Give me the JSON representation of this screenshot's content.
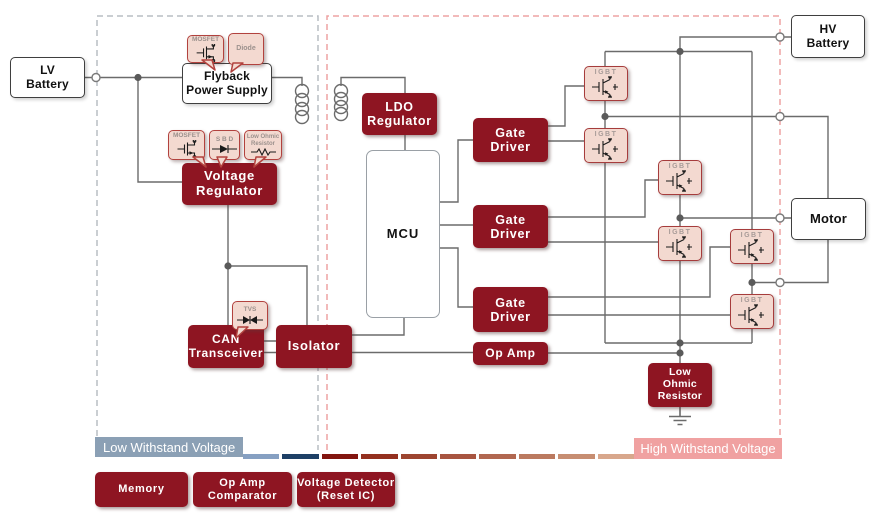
{
  "boxes": {
    "lv_battery": "LV\nBattery",
    "hv_battery": "HV\nBattery",
    "motor": "Motor",
    "flyback": "Flyback\nPower Supply",
    "voltage_regulator": "Voltage\nRegulator",
    "ldo_regulator": "LDO\nRegulator",
    "mcu": "MCU",
    "gate_driver": "Gate\nDriver",
    "can_transceiver": "CAN\nTransceiver",
    "isolator": "Isolator",
    "op_amp": "Op Amp",
    "low_ohmic_resistor": "Low\nOhmic\nResistor",
    "igbt": "IGBT"
  },
  "callouts": {
    "mosfet": "MOSFET",
    "diode": "Diode",
    "sbd": "S B D",
    "low_ohmic": "Low Ohmic\nResistor",
    "tvs": "TVS"
  },
  "bars": {
    "low_label": "Low Withstand Voltage",
    "high_label": "High Withstand Voltage",
    "low_color": "#8ba0b5",
    "high_color": "#f0a1a1",
    "segments": [
      "#86a0c2",
      "#1e4066",
      "#82150f",
      "#94301f",
      "#9d4530",
      "#a85540",
      "#b16750",
      "#bb7a60",
      "#c78e72",
      "#d8a78c"
    ]
  },
  "legend": [
    {
      "label": "Memory"
    },
    {
      "label": "Op Amp\nComparator"
    },
    {
      "label": "Voltage Detector\n(Reset IC)"
    }
  ],
  "colors": {
    "block_red": "#8e1522",
    "callout_fill": "#f3d9d0",
    "callout_border": "#b2423e",
    "wire": "#6b6b6b",
    "low_region_dash": "#b9bdc4",
    "high_region_dash": "#eda3a3"
  }
}
